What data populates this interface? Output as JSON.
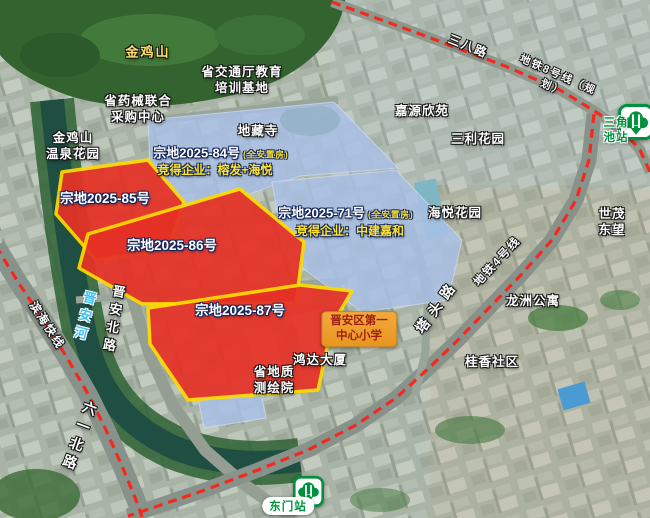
{
  "colors": {
    "parcel-red": "#e63125",
    "parcel-yellow-border": "#ffd900",
    "parcel-blue": "#a9c1e8",
    "metro-dash-red": "#f5281e",
    "metro-green": "#00913e",
    "bid-yellow": "#ffe42e",
    "school-box-gold": "#f2a93b",
    "school-text-red": "#9e1d15",
    "mountain-label-yellow": "#ffe06e",
    "river-label-blue": "#3fc0f2"
  },
  "parcels": {
    "p84": {
      "title": "宗地2025-84号",
      "tag": "(全安置房)",
      "bid": "竞得企业：榕发+海悦"
    },
    "p71": {
      "title": "宗地2025-71号",
      "tag": "(全安置房)",
      "bid": "竞得企业：中建嘉和"
    },
    "p85": {
      "title": "宗地2025-85号"
    },
    "p86": {
      "title": "宗地2025-86号"
    },
    "p87": {
      "title": "宗地2025-87号"
    }
  },
  "places": {
    "jinjishan": "金鸡山",
    "yaoxie": "省药械联合\n采购中心",
    "wenquan": "金鸡山\n温泉花园",
    "jiaotong": "省交通厅教育\n培训基地",
    "dizangsi": "地藏寺",
    "jiayuan": "嘉源欣苑",
    "sanli": "三利花园",
    "haiyue": "海悦花园",
    "shimao": "世茂东望",
    "longzhou": "龙洲公寓",
    "guixiang": "桂香社区",
    "hongda": "鸿达大厦",
    "dizhi": "省地质\n测绘院",
    "school": "晋安区第一\n中心小学"
  },
  "roads": {
    "sanba": "三八路",
    "line8": "地铁8号线（规划）",
    "binhai": "滨海快线",
    "line4": "地铁4号线",
    "tatou": "塔头路",
    "jinanbei": "晋安北路",
    "jinanriver": "晋安河",
    "liuyibei": "六一北路"
  },
  "stations": {
    "sanjiaochi": "三角池站",
    "dongmen": "东门站"
  }
}
